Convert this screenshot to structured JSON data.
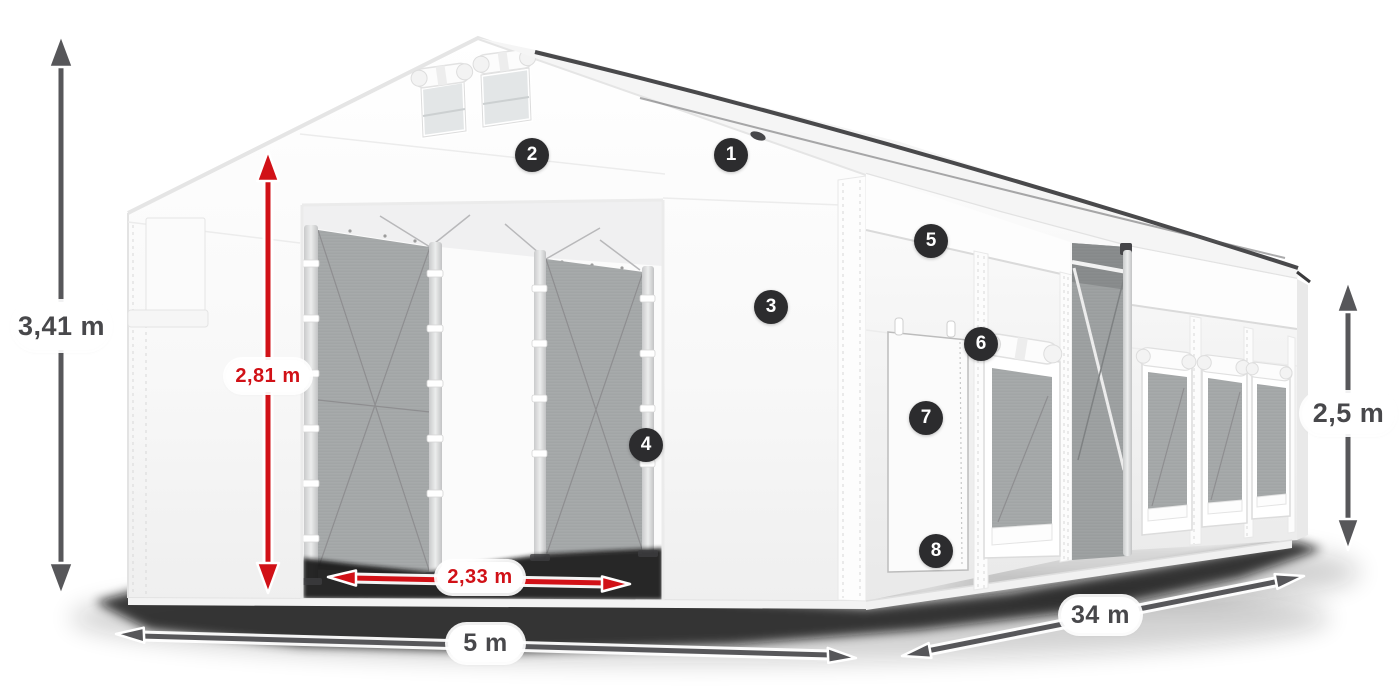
{
  "title": "Tent construction diagram with dimensions",
  "colors": {
    "canvas_bg": "#ffffff",
    "arrow_gray": "#57575a",
    "dimension_red": "#d11117",
    "label_text": "#48484b",
    "badge_bg": "#2c2c2e",
    "badge_text": "#ffffff",
    "tent_white": "#ffffff",
    "mesh_gray": "#a7aaab",
    "shadow": "#0b0b0b"
  },
  "dimensions": [
    {
      "id": "total-height",
      "text": "3,41 m",
      "style": "gray",
      "orientation": "vertical"
    },
    {
      "id": "entrance-height",
      "text": "2,81 m",
      "style": "red",
      "orientation": "vertical"
    },
    {
      "id": "entrance-width",
      "text": "2,33 m",
      "style": "red",
      "orientation": "horizontal"
    },
    {
      "id": "front-width",
      "text": "5 m",
      "style": "gray",
      "orientation": "horizontal"
    },
    {
      "id": "side-length",
      "text": "34 m",
      "style": "gray",
      "orientation": "horizontal"
    },
    {
      "id": "side-wall-height",
      "text": "2,5 m",
      "style": "gray",
      "orientation": "vertical"
    }
  ],
  "callouts": [
    {
      "number": "1"
    },
    {
      "number": "2"
    },
    {
      "number": "3"
    },
    {
      "number": "4"
    },
    {
      "number": "5"
    },
    {
      "number": "6"
    },
    {
      "number": "7"
    },
    {
      "number": "8"
    }
  ]
}
